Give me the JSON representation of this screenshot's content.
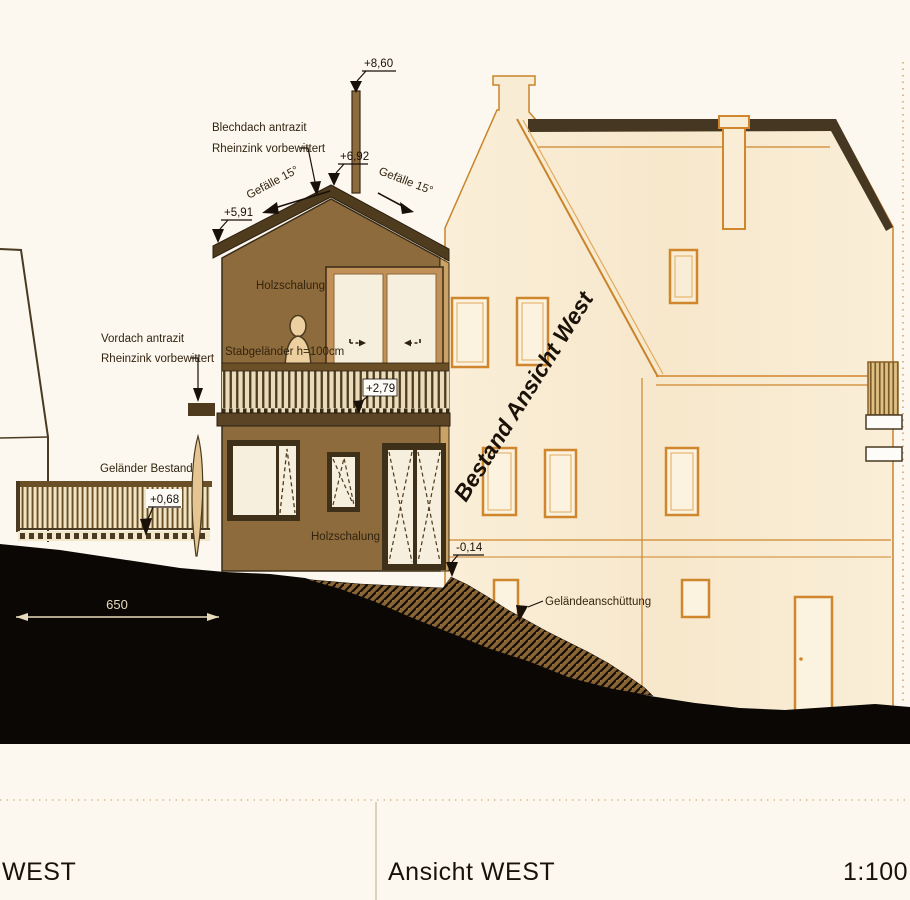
{
  "drawing": {
    "title_block": {
      "left_title": "WEST",
      "center_title": "Ansicht WEST",
      "scale": "1:100"
    },
    "labels": {
      "roof_material_1": "Blechdach antrazit",
      "roof_material_2": "Rheinzink vorbewittert",
      "slope_left": "Gefälle 15°",
      "slope_right": "Gefälle 15°",
      "canopy_1": "Vordach antrazit",
      "canopy_2": "Rheinzink vorbewittert",
      "existing_railing": "Geländer Bestand",
      "balcony_railing": "Stabgeländer h=100cm",
      "cladding_upper": "Holzschalung",
      "cladding_lower": "Holzschalung",
      "ground_fill": "Geländeanschüttung",
      "existing_building": "Bestand Ansicht West"
    },
    "elevation_marks": {
      "chimney_top": "+8,60",
      "ridge": "+6,92",
      "eaves": "+5,91",
      "balcony_level": "+2,79",
      "terrace_level": "+0,68",
      "ground_level": "-0,14"
    },
    "dimensions": {
      "terrace_width": "650"
    },
    "colors": {
      "paper": "#fcf8f0",
      "new_building_wall": "#8d6b3c",
      "new_building_roof": "#4f3b1e",
      "existing_building_fill": "#f9edd5",
      "existing_building_line": "#cf862c",
      "terrain": "#0a0705",
      "glass": "#f7efdd",
      "annotation_text": "#33240f"
    }
  }
}
